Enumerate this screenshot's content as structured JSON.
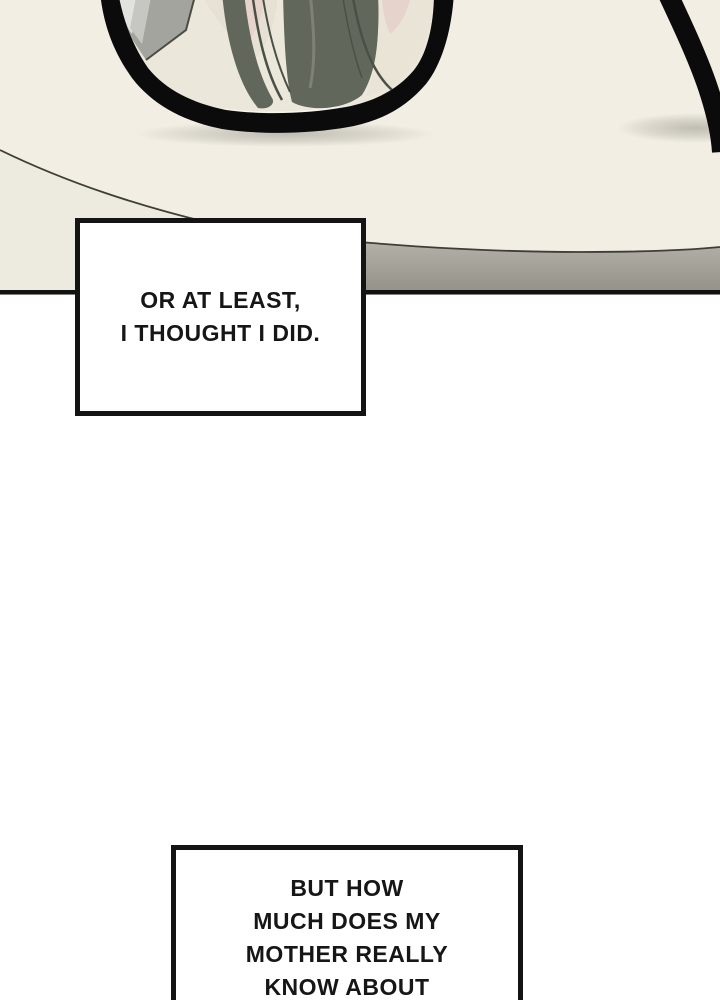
{
  "page": {
    "background": "#ffffff"
  },
  "panel": {
    "colors": {
      "cream": "#f2eee3",
      "cream_shaded": "#edeadf",
      "desk_line": "#3e3e37",
      "gray_band_top": "#b4b1a8",
      "gray_band_bottom": "#95928a",
      "panel_border": "#121212",
      "frame_black": "#0b0b0b",
      "lens_base": "#ece7db",
      "slab_gray": "#a3a49e",
      "slab_stripe_light": "#e2e3df",
      "slab_stripe_mid": "#c6c7c2",
      "slab_edge": "#4a4d44",
      "skin_pale": "#e7e0d4",
      "skin": "#e6d3cc",
      "hair": "#62675b",
      "hair_streak": "#7d8274",
      "hair_strand": "#4b5046",
      "pale_right": "#eae4d6",
      "shadow": "#b7b4aa",
      "glint": "#f6f4ec"
    }
  },
  "captions": [
    {
      "id": "caption-1",
      "lines": [
        "OR AT LEAST,",
        "I THOUGHT I DID."
      ]
    },
    {
      "id": "caption-2",
      "lines": [
        "BUT HOW",
        "MUCH DOES MY",
        "MOTHER REALLY",
        "KNOW ABOUT"
      ]
    }
  ]
}
